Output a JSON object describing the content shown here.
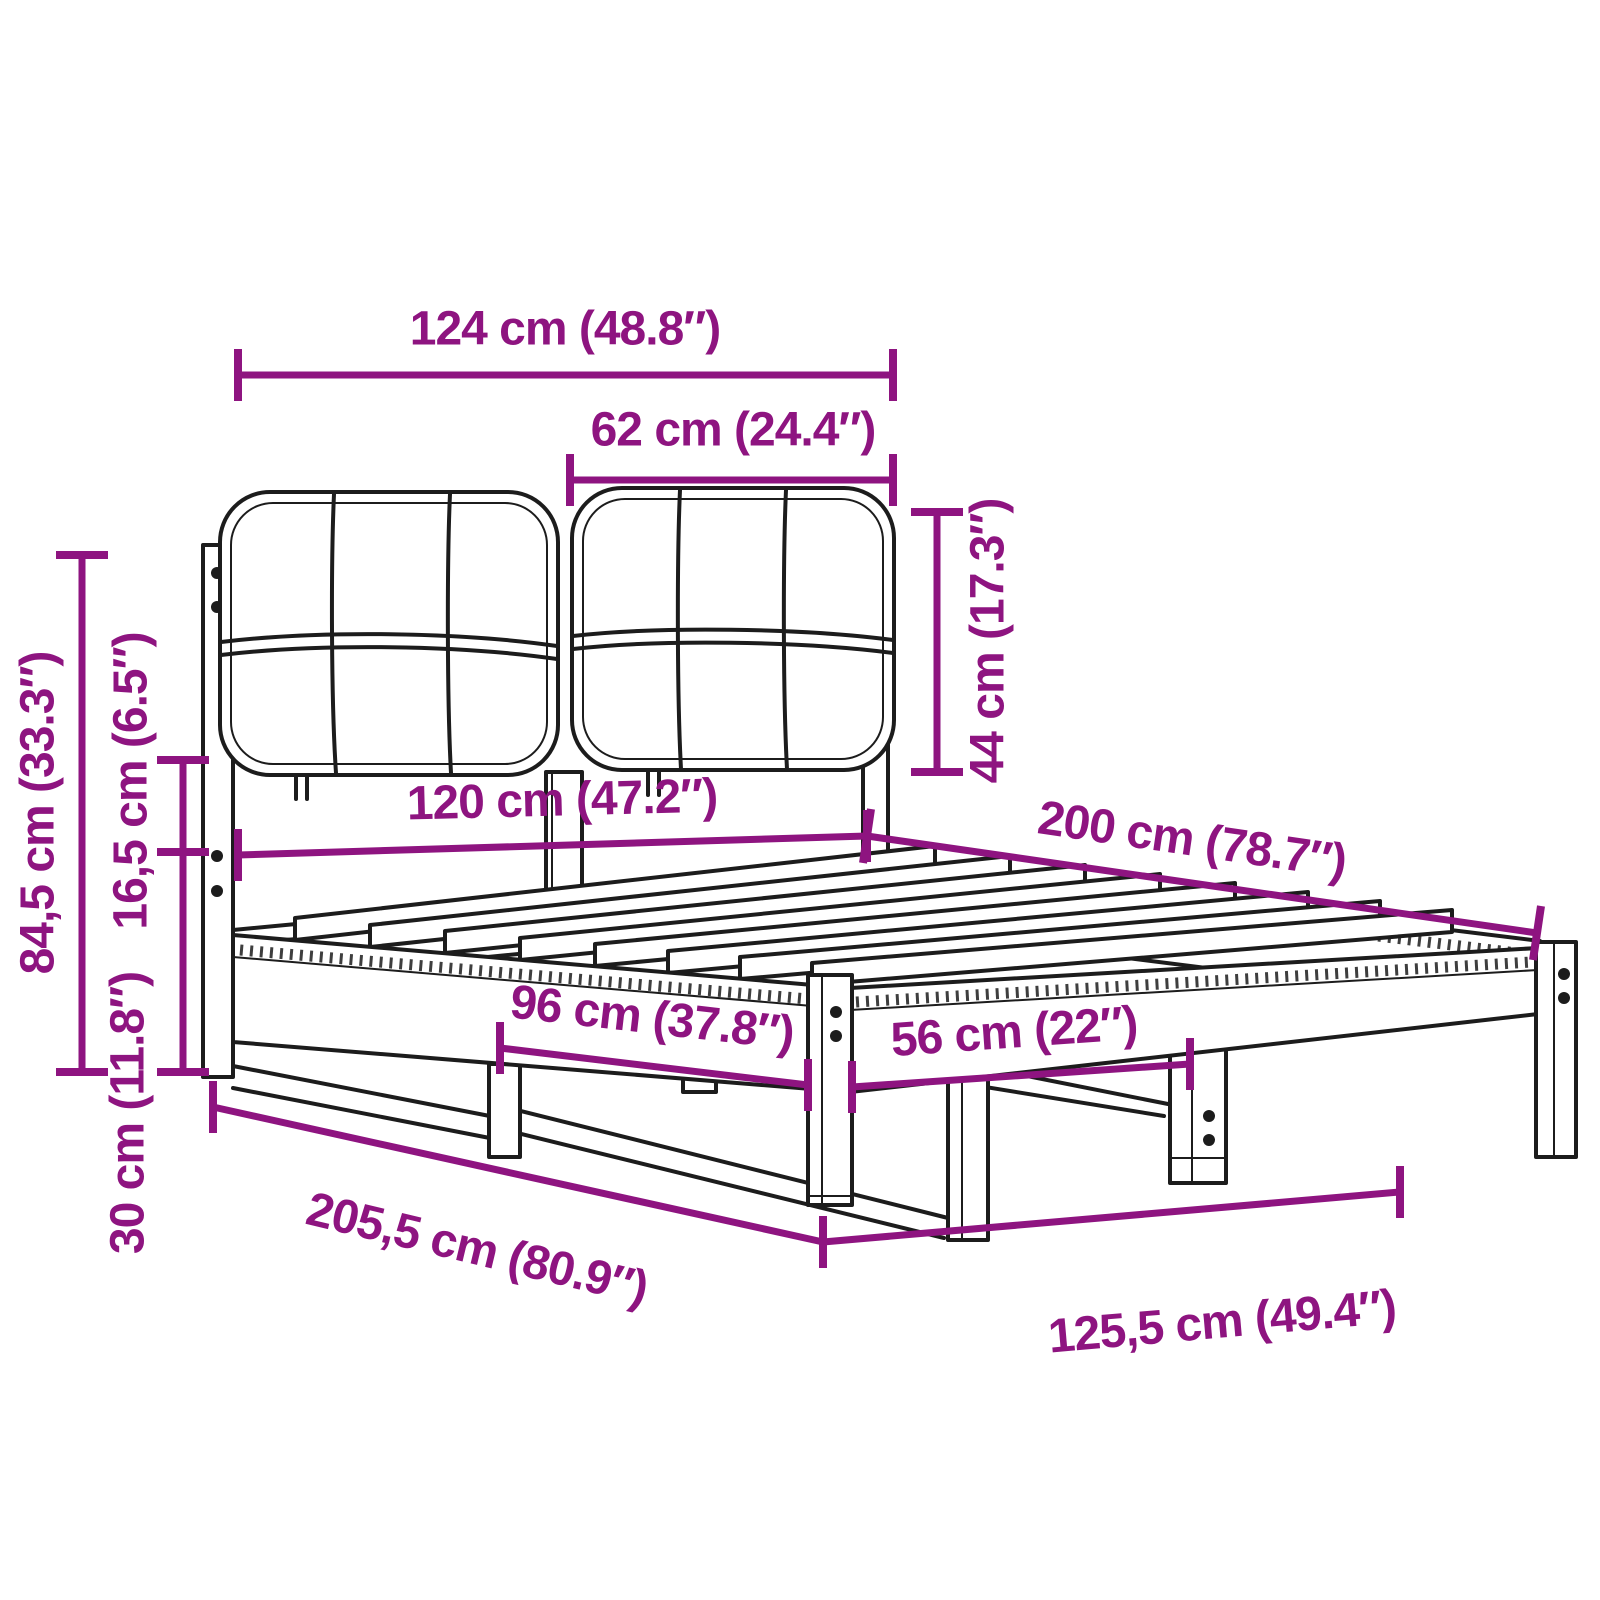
{
  "colors": {
    "accent": "#8e1480",
    "line": "#1c1c1c",
    "background": "#ffffff"
  },
  "diagram": {
    "type": "product-dimension-diagram",
    "subject": "wooden bed frame with upholstered two-panel headboard and slatted base"
  },
  "dimensions": [
    {
      "id": "headboard-width",
      "label": "124 cm (48.8″)",
      "cm": "124",
      "inches": "48.8"
    },
    {
      "id": "cushion-width",
      "label": "62 cm (24.4″)",
      "cm": "62",
      "inches": "24.4"
    },
    {
      "id": "cushion-height",
      "label": "44 cm (17.3″)",
      "cm": "44",
      "inches": "17.3"
    },
    {
      "id": "bed-width",
      "label": "120 cm (47.2″)",
      "cm": "120",
      "inches": "47.2"
    },
    {
      "id": "bed-length",
      "label": "200 cm (78.7″)",
      "cm": "200",
      "inches": "78.7"
    },
    {
      "id": "headboard-height",
      "label": "84,5 cm (33.3″)",
      "cm": "84,5",
      "inches": "33.3"
    },
    {
      "id": "headboard-gap",
      "label": "16,5 cm (6.5″)",
      "cm": "16,5",
      "inches": "6.5"
    },
    {
      "id": "frame-height",
      "label": "30 cm (11.8″)",
      "cm": "30",
      "inches": "11.8"
    },
    {
      "id": "leg-span-side",
      "label": "96 cm (37.8″)",
      "cm": "96",
      "inches": "37.8"
    },
    {
      "id": "leg-span-foot",
      "label": "56 cm (22″)",
      "cm": "56",
      "inches": "22"
    },
    {
      "id": "total-length",
      "label": "205,5 cm (80.9″)",
      "cm": "205,5",
      "inches": "80.9"
    },
    {
      "id": "total-width",
      "label": "125,5 cm (49.4″)",
      "cm": "125,5",
      "inches": "49.4"
    }
  ]
}
